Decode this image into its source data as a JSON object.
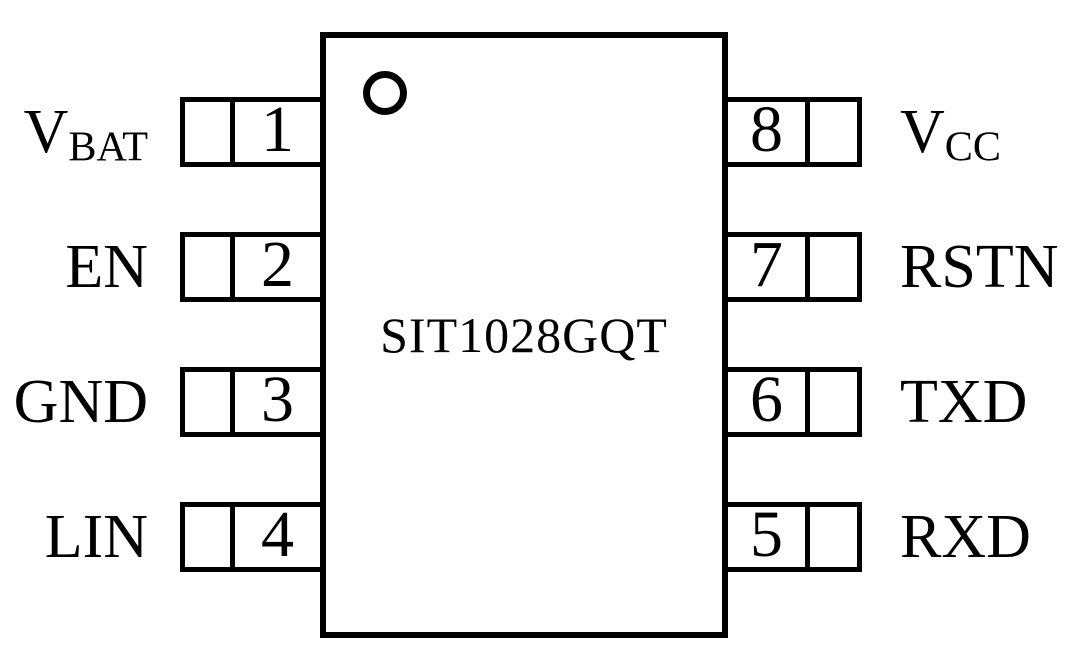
{
  "chip": {
    "part_number": "SIT1028GQT"
  },
  "pins": {
    "left": [
      {
        "number": "1",
        "name": "V",
        "name_sub": "BAT"
      },
      {
        "number": "2",
        "name": "EN",
        "name_sub": ""
      },
      {
        "number": "3",
        "name": "GND",
        "name_sub": ""
      },
      {
        "number": "4",
        "name": "LIN",
        "name_sub": ""
      }
    ],
    "right": [
      {
        "number": "8",
        "name": "V",
        "name_sub": "CC"
      },
      {
        "number": "7",
        "name": "RSTN",
        "name_sub": ""
      },
      {
        "number": "6",
        "name": "TXD",
        "name_sub": ""
      },
      {
        "number": "5",
        "name": "RXD",
        "name_sub": ""
      }
    ]
  },
  "icons": {
    "pin1_indicator": "circle"
  },
  "colors": {
    "line": "#000000",
    "background": "#ffffff"
  }
}
